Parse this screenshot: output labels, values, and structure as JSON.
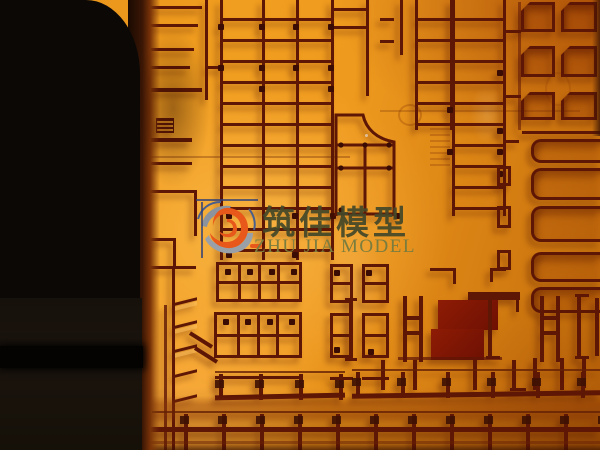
{
  "watermark": {
    "chinese": "筑佳模型",
    "english": "ZHU JIA MODEL"
  },
  "colors": {
    "line": "#5E1605",
    "dot": "#3A0C03",
    "wm_cn": "#434829",
    "wm_en": "#7B7D3E",
    "logo_gray": "#8C939D",
    "logo_orange": "#E8581A",
    "logo_blue": "#4A5F8C"
  }
}
